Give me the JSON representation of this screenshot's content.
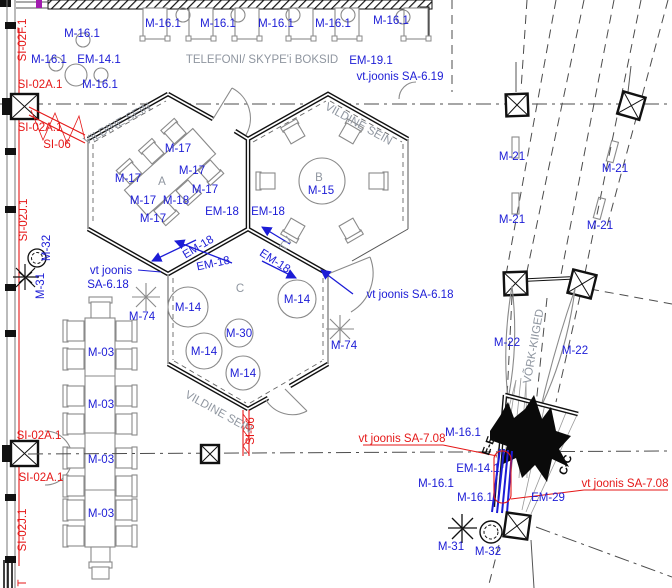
{
  "colors": {
    "label_blue": "#1c1cd6",
    "markup_red": "#e51717",
    "annotation_gray": "#8f96a0",
    "wall_black": "#111111",
    "furniture_gray": "#8a8a8a"
  },
  "symbols": {
    "column-symbol": "boxed-X square",
    "plant-symbol": "scribble star / circle",
    "swing-symbol": "vertical lens shape",
    "cable-route-symbol": "red zigzag between parallel lines"
  },
  "labels": {
    "blue": [
      {
        "n": "label-m16-1-a",
        "t": "M-16.1",
        "x": 82,
        "y": 37
      },
      {
        "n": "label-m16-1-b",
        "t": "M-16.1",
        "x": 49,
        "y": 63
      },
      {
        "n": "label-em14-1-a",
        "t": "EM-14.1",
        "x": 99,
        "y": 63
      },
      {
        "n": "label-m16-1-c",
        "t": "M-16.1",
        "x": 100,
        "y": 88
      },
      {
        "n": "label-m16-1-booth1",
        "t": "M-16.1",
        "x": 163,
        "y": 27
      },
      {
        "n": "label-m16-1-booth2",
        "t": "M-16.1",
        "x": 218,
        "y": 27
      },
      {
        "n": "label-m16-1-booth3",
        "t": "M-16.1",
        "x": 276,
        "y": 27
      },
      {
        "n": "label-m16-1-booth4",
        "t": "M-16.1",
        "x": 333,
        "y": 27
      },
      {
        "n": "label-m16-1-booth5",
        "t": "M-16.1",
        "x": 391,
        "y": 24
      },
      {
        "n": "label-em19-1",
        "t": "EM-19.1",
        "x": 371,
        "y": 64
      },
      {
        "n": "label-vt-joonis-sa-6-19",
        "t": "vt.joonis SA-6.19",
        "x": 400,
        "y": 80
      },
      {
        "n": "label-m17-1",
        "t": "M-17",
        "x": 178,
        "y": 152
      },
      {
        "n": "label-m17-2",
        "t": "M-17",
        "x": 192,
        "y": 174
      },
      {
        "n": "label-m17-3",
        "t": "M-17",
        "x": 128,
        "y": 182
      },
      {
        "n": "label-m17-4",
        "t": "M-17",
        "x": 205,
        "y": 193
      },
      {
        "n": "label-m17-5",
        "t": "M-17",
        "x": 143,
        "y": 204
      },
      {
        "n": "label-m18",
        "t": "M-18",
        "x": 176,
        "y": 204
      },
      {
        "n": "label-m17-6",
        "t": "M-17",
        "x": 153,
        "y": 222
      },
      {
        "n": "label-m15",
        "t": "M-15",
        "x": 321,
        "y": 194
      },
      {
        "n": "label-em18-1",
        "t": "EM-18",
        "x": 222,
        "y": 215
      },
      {
        "n": "label-em18-2",
        "t": "EM-18",
        "x": 268,
        "y": 215
      },
      {
        "n": "label-em18-3",
        "t": "EM-18",
        "x": 200,
        "y": 250,
        "r": -31
      },
      {
        "n": "label-em18-4",
        "t": "EM-18",
        "x": 214,
        "y": 267,
        "r": -12
      },
      {
        "n": "label-em18-5",
        "t": "EM-18",
        "x": 273,
        "y": 264,
        "r": 33
      },
      {
        "n": "label-vt-joonis-line1",
        "t": "vt joonis",
        "x": 111,
        "y": 274
      },
      {
        "n": "label-vt-joonis-line2",
        "t": "SA-6.18",
        "x": 108,
        "y": 288
      },
      {
        "n": "label-m74-left",
        "t": "M-74",
        "x": 142,
        "y": 320
      },
      {
        "n": "label-m14-1",
        "t": "M-14",
        "x": 188,
        "y": 311
      },
      {
        "n": "label-m14-2",
        "t": "M-14",
        "x": 297,
        "y": 303
      },
      {
        "n": "label-m30",
        "t": "M-30",
        "x": 239,
        "y": 337
      },
      {
        "n": "label-m14-3",
        "t": "M-14",
        "x": 204,
        "y": 355
      },
      {
        "n": "label-m14-4",
        "t": "M-14",
        "x": 243,
        "y": 377
      },
      {
        "n": "label-m74-right",
        "t": "M-74",
        "x": 344,
        "y": 349
      },
      {
        "n": "label-vt-joonis-sa-6-18-right",
        "t": "vt joonis SA-6.18",
        "x": 410,
        "y": 298
      },
      {
        "n": "label-m32-left",
        "t": "M-32",
        "x": 50,
        "y": 248,
        "r": -90
      },
      {
        "n": "label-m31-left",
        "t": "M-31",
        "x": 44,
        "y": 286,
        "r": -90
      },
      {
        "n": "label-m03-1",
        "t": "M-03",
        "x": 101,
        "y": 356
      },
      {
        "n": "label-m03-2",
        "t": "M-03",
        "x": 101,
        "y": 408
      },
      {
        "n": "label-m03-3",
        "t": "M-03",
        "x": 101,
        "y": 463
      },
      {
        "n": "label-m03-4",
        "t": "M-03",
        "x": 101,
        "y": 517
      },
      {
        "n": "label-m21-1",
        "t": "M-21",
        "x": 512,
        "y": 160
      },
      {
        "n": "label-m21-2",
        "t": "M-21",
        "x": 615,
        "y": 172
      },
      {
        "n": "label-m21-3",
        "t": "M-21",
        "x": 512,
        "y": 223
      },
      {
        "n": "label-m21-4",
        "t": "M-21",
        "x": 600,
        "y": 229
      },
      {
        "n": "label-m22-1",
        "t": "M-22",
        "x": 507,
        "y": 346
      },
      {
        "n": "label-m22-2",
        "t": "M-22",
        "x": 575,
        "y": 354
      },
      {
        "n": "label-m16-1-d",
        "t": "M-16.1",
        "x": 463,
        "y": 436
      },
      {
        "n": "label-em14-1-b",
        "t": "EM-14.1",
        "x": 478,
        "y": 472
      },
      {
        "n": "label-m16-1-e",
        "t": "M-16.1",
        "x": 436,
        "y": 487
      },
      {
        "n": "label-m16-1-f",
        "t": "M-16.1",
        "x": 475,
        "y": 501
      },
      {
        "n": "label-em29",
        "t": "EM-29",
        "x": 548,
        "y": 501
      },
      {
        "n": "label-m31-right",
        "t": "M-31",
        "x": 451,
        "y": 550
      },
      {
        "n": "label-m32-right",
        "t": "M-32",
        "x": 488,
        "y": 555
      }
    ],
    "red": [
      {
        "n": "label-si02f-1",
        "t": "SI-02F.1",
        "x": 26,
        "y": 40,
        "r": -90
      },
      {
        "n": "label-si02a-1-a",
        "t": "SI-02A.1",
        "x": 40,
        "y": 88
      },
      {
        "n": "label-si02a-1-b",
        "t": "SI-02A.1",
        "x": 40,
        "y": 131
      },
      {
        "n": "label-si06-left",
        "t": "SI-06",
        "x": 57,
        "y": 148
      },
      {
        "n": "label-si02j-1-a",
        "t": "SI-02J.1",
        "x": 27,
        "y": 220,
        "r": -90
      },
      {
        "n": "label-si02a-1-c",
        "t": "SI-02A.1",
        "x": 39,
        "y": 439
      },
      {
        "n": "label-si02a-1-d",
        "t": "SI-02A.1",
        "x": 41,
        "y": 481
      },
      {
        "n": "label-si02j-1-b",
        "t": "SI-02J.1",
        "x": 26,
        "y": 530,
        "r": -90
      },
      {
        "n": "label-si06-bottom",
        "t": "SI-06",
        "x": 254,
        "y": 431,
        "r": -90
      },
      {
        "n": "label-vt-joonis-sa-7-08-left",
        "t": "vt joonis SA-7.08",
        "x": 402,
        "y": 442
      },
      {
        "n": "label-vt-joonis-sa-7-08-right",
        "t": "vt joonis SA-7.08",
        "x": 625,
        "y": 487
      },
      {
        "n": "label-partial-t",
        "t": "T",
        "x": 26,
        "y": 583,
        "r": -90
      }
    ],
    "gray": [
      {
        "n": "label-telefoni-skype-boksid",
        "t": "TELEFONI/ SKYPE'i BOKSID",
        "x": 262,
        "y": 63,
        "s": 12.5
      },
      {
        "n": "label-vildine-sein-a",
        "t": "VILDINE SEIN",
        "x": 119,
        "y": 127,
        "r": -29,
        "s": 9.5
      },
      {
        "n": "label-vildine-sein-b",
        "t": "VILDINE SEIN",
        "x": 357,
        "y": 127,
        "r": 29,
        "s": 9.5
      },
      {
        "n": "label-vildine-sein-c",
        "t": "VILDINE SEIN",
        "x": 217,
        "y": 415,
        "r": 29,
        "s": 9.5
      },
      {
        "n": "label-booth-a",
        "t": "A",
        "x": 162,
        "y": 185,
        "s": 15
      },
      {
        "n": "label-booth-b",
        "t": "B",
        "x": 319,
        "y": 181,
        "s": 15
      },
      {
        "n": "label-booth-c",
        "t": "C",
        "x": 240,
        "y": 292,
        "s": 15
      },
      {
        "n": "label-vork-kiiged",
        "t": "VÕRK-KIIGED",
        "x": 537,
        "y": 347,
        "r": -80,
        "s": 9.5
      },
      {
        "n": "label-tv",
        "t": "TV",
        "x": 289,
        "y": 246,
        "r": -55,
        "s": 7
      }
    ],
    "black": [
      {
        "n": "label-section-e-e",
        "t": "E-E",
        "x": 492,
        "y": 447,
        "r": -70,
        "s": 16,
        "w": "bold"
      },
      {
        "n": "label-section-c-c",
        "t": "C-C",
        "x": 569,
        "y": 466,
        "r": -72,
        "s": 16,
        "w": "bold"
      }
    ]
  }
}
